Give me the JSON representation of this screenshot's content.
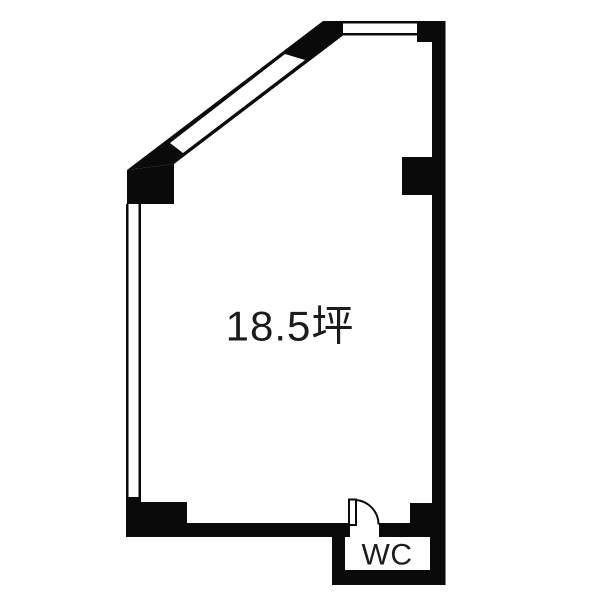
{
  "floorplan": {
    "area_label": "18.5坪",
    "wc_label": "WC",
    "colors": {
      "wall": "#0a0a0a",
      "text": "#1c1c1c",
      "background": "#ffffff"
    }
  }
}
